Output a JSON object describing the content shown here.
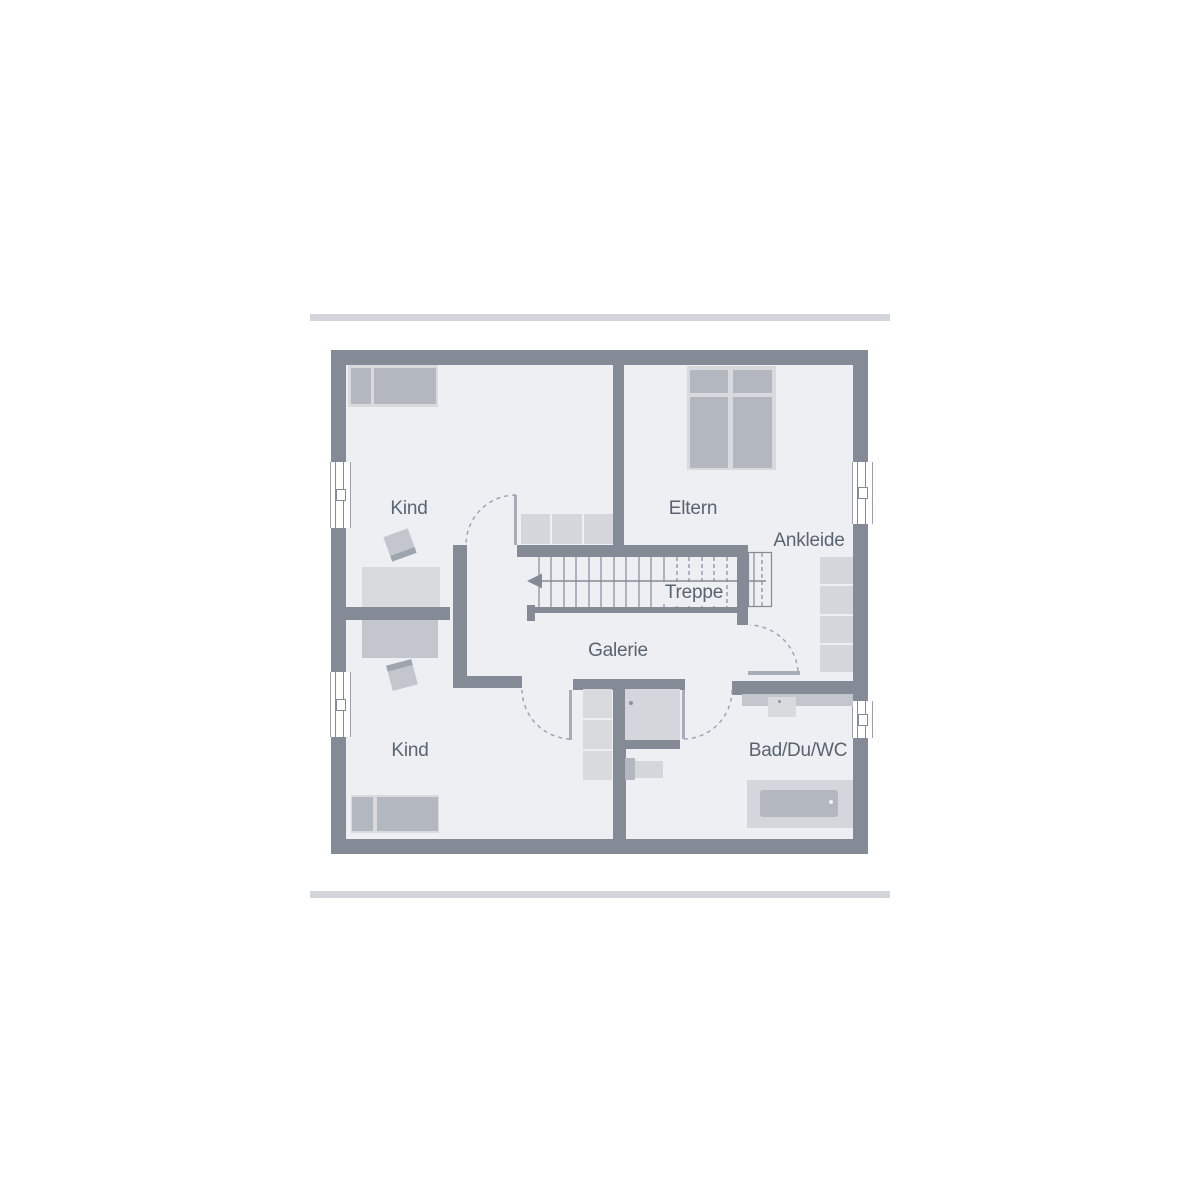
{
  "palette": {
    "page-bg": "#ffffff",
    "rule": "#d3d5da",
    "wall": "#848b97",
    "room": "#edeff2",
    "furn-light": "#d8dade",
    "furn-mid": "#c3c6cd",
    "furn-dark": "#b3b7c0",
    "furn-soft": "#d4d6db",
    "furn-edge": "#9fa5af",
    "line": "#848b97",
    "dash": "#9aa1ac",
    "leaf": "#a7adb7",
    "label": "#5a6370",
    "window": "#ffffff",
    "dot": "#8b929e"
  },
  "floor_plan": {
    "labels": {
      "kind_upper": "Kind",
      "eltern": "Eltern",
      "ankleide": "Ankleide",
      "treppe": "Treppe",
      "galerie": "Galerie",
      "kind_lower": "Kind",
      "bad": "Bad/Du/WC"
    }
  }
}
